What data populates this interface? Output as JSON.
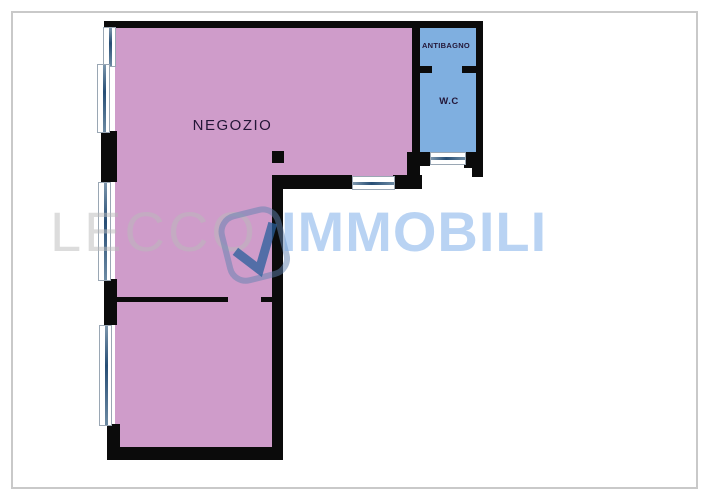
{
  "plan": {
    "rooms": {
      "negozio": {
        "label": "NEGOZIO"
      },
      "antibagno": {
        "label": "ANTIBAGNO"
      },
      "wc": {
        "label": "W.C"
      }
    },
    "colors": {
      "room-negozio": "#cf9cca",
      "room-wet": "#7fafe0",
      "wall": "#0b0b0b",
      "window-line": "#274e75",
      "frame-border": "#c9c9c9"
    }
  },
  "watermark": {
    "brand_left": "LECCO",
    "brand_right": "IMMOBILI",
    "logo_icon": "check-pin-logo"
  }
}
